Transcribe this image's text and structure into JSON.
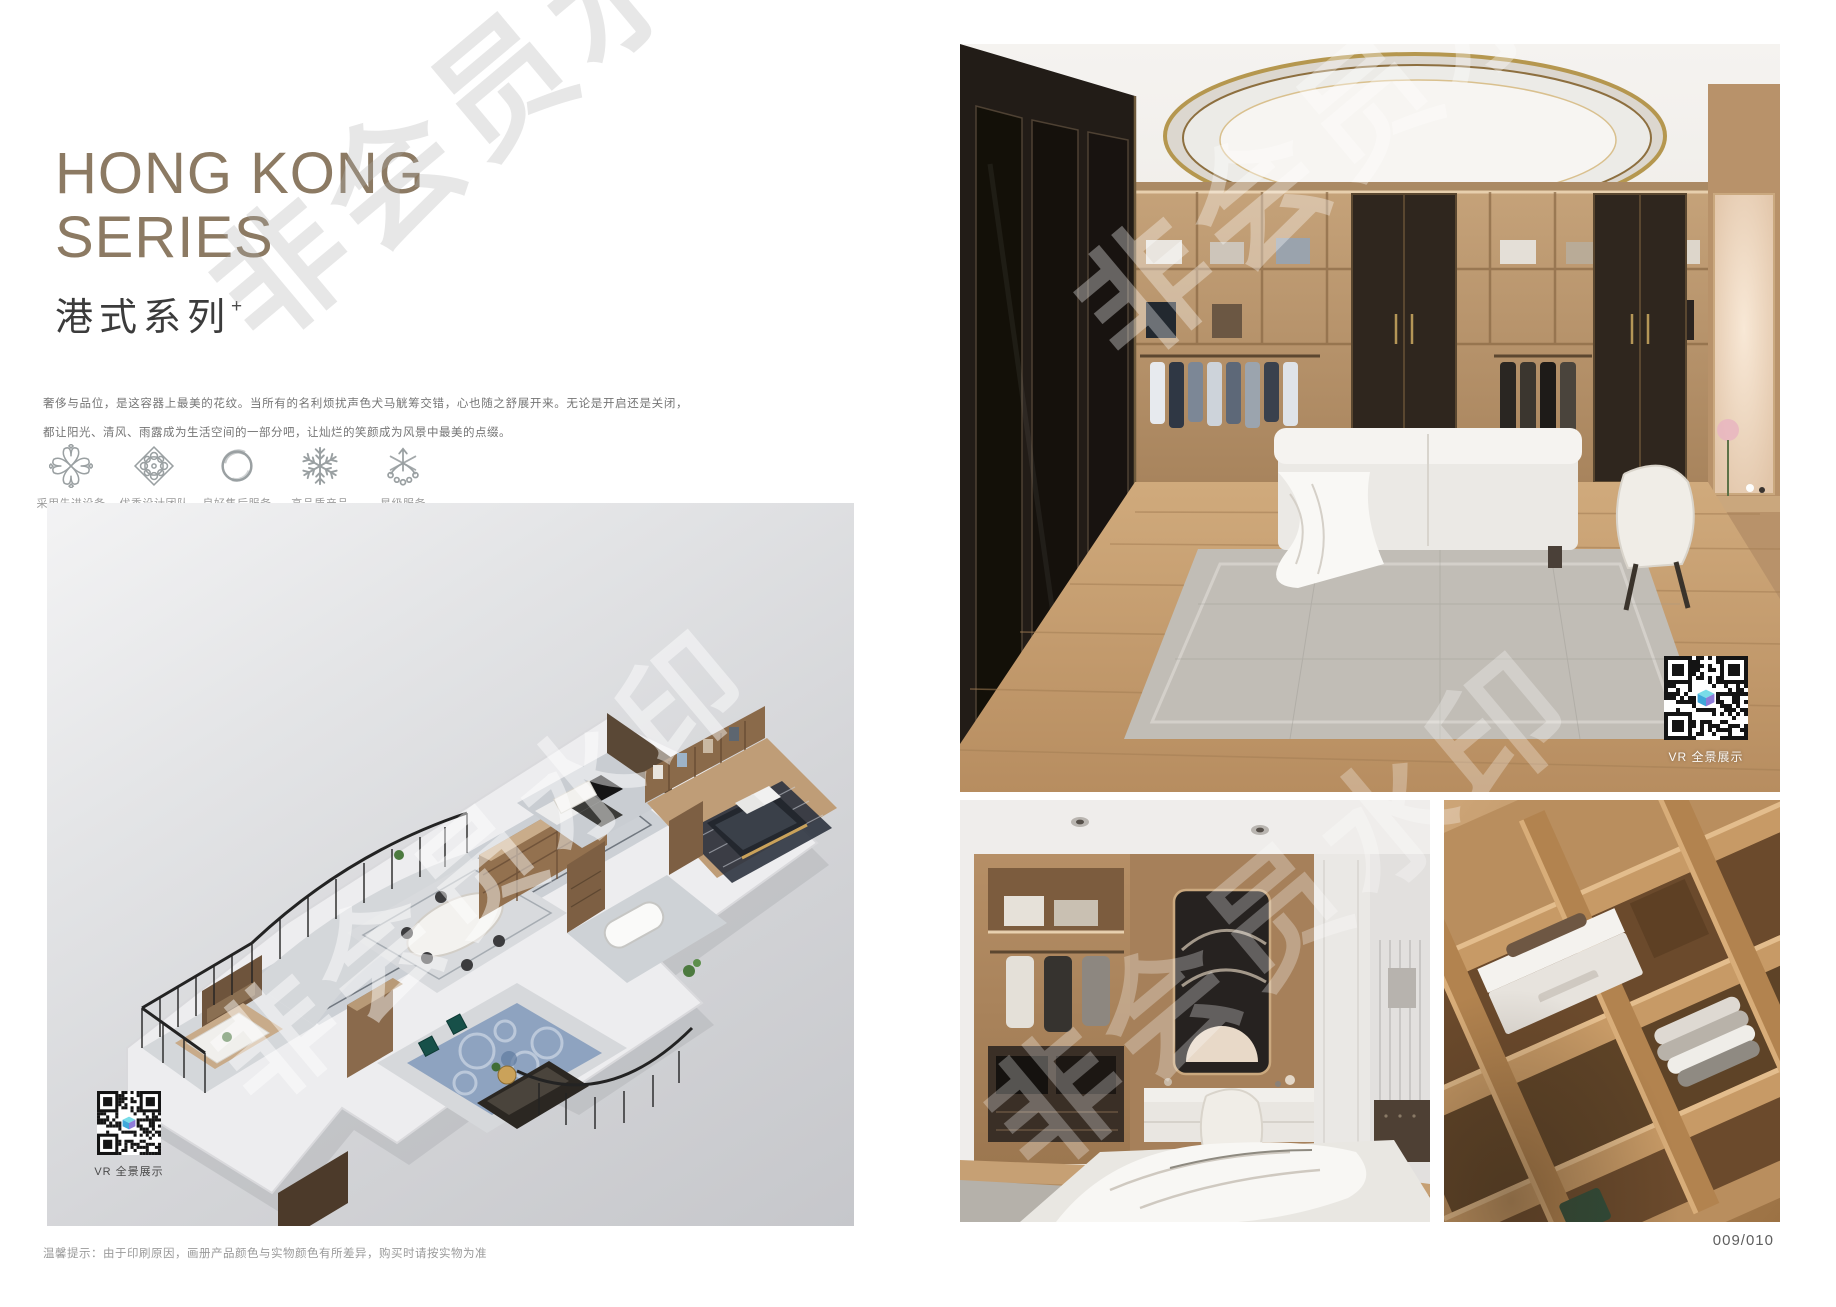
{
  "colors": {
    "accent": "#8c7a63",
    "panel_gray": "#d9dadd",
    "qr_logo_top": "#79dce8",
    "qr_logo_left": "#3fa8da",
    "qr_logo_right": "#8f7cd9"
  },
  "watermark": {
    "text": "非会员水印"
  },
  "left_page": {
    "title_line1": "HONG KONG",
    "title_line2": "SERIES",
    "subtitle": "港式系列",
    "subtitle_sup": "+",
    "description": "奢侈与品位，是这容器上最美的花纹。当所有的名利烦扰声色犬马觥筹交错，心也随之舒展开来。无论是开启还是关闭，都让阳光、清风、雨露成为生活空间的一部分吧，让灿烂的笑颜成为风景中最美的点缀。",
    "features": [
      {
        "icon": "pinwheel-icon",
        "label": "采用先进设备"
      },
      {
        "icon": "rosette-icon",
        "label": "优秀设计团队"
      },
      {
        "icon": "ring-icon",
        "label": "良好售后服务"
      },
      {
        "icon": "snowflake-icon",
        "label": "高品质产品"
      },
      {
        "icon": "star-icon",
        "label": "星级服务"
      }
    ],
    "vr_label": "VR 全景展示",
    "disclaimer": "温馨提示：由于印刷原因，画册产品颜色与实物颜色有所差异，购买时请按实物为准"
  },
  "right_page": {
    "vr_label": "VR 全景展示",
    "page_number": "009/010"
  }
}
